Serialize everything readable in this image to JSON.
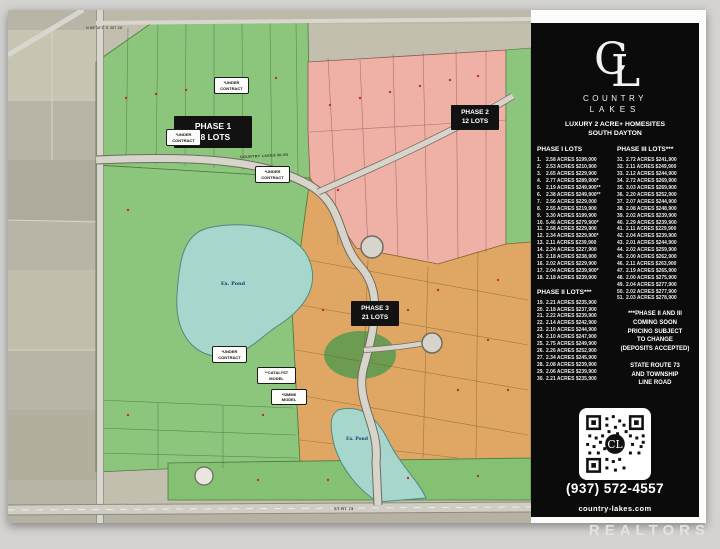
{
  "flyer": {
    "brand": {
      "monogram": "CL",
      "monogram_c": "C",
      "monogram_l": "L",
      "name_line1": "COUNTRY",
      "name_line2": "LAKES",
      "tagline_line1": "LUXURY 2 ACRE+ HOMESITES",
      "tagline_line2": "SOUTH DAYTON"
    },
    "phase1": {
      "header": "PHASE I LOTS",
      "lots": [
        {
          "n": "1.",
          "t": "2.58 ACRES $199,000"
        },
        {
          "n": "2.",
          "t": "2.53 ACRES $210,900"
        },
        {
          "n": "3.",
          "t": "2.65 ACRES $229,900"
        },
        {
          "n": "4.",
          "t": "2.77 ACRES $289,900*"
        },
        {
          "n": "5.",
          "t": "2.19 ACRES $249,900**"
        },
        {
          "n": "6.",
          "t": "2.38 ACRES $249,900**"
        },
        {
          "n": "7.",
          "t": "2.56 ACRES $229,000"
        },
        {
          "n": "8.",
          "t": "2.55 ACRES $219,900"
        },
        {
          "n": "9.",
          "t": "3.30 ACRES $199,900"
        },
        {
          "n": "10.",
          "t": "5.46 ACRES $279,900*"
        },
        {
          "n": "11.",
          "t": "2.58 ACRES $229,900"
        },
        {
          "n": "12.",
          "t": "2.34 ACRES $229,900*"
        },
        {
          "n": "13.",
          "t": "2.11 ACRES $239,900"
        },
        {
          "n": "14.",
          "t": "2.24 ACRES $227,900"
        },
        {
          "n": "15.",
          "t": "2.18 ACRES $238,900"
        },
        {
          "n": "16.",
          "t": "2.02 ACRES $229,900"
        },
        {
          "n": "17.",
          "t": "2.04 ACRES $239,900*"
        },
        {
          "n": "18.",
          "t": "2.18 ACRES $239,900"
        }
      ]
    },
    "phase2": {
      "header": "PHASE II LOTS***",
      "lots": [
        {
          "n": "19.",
          "t": "2.21 ACRES $235,900"
        },
        {
          "n": "20.",
          "t": "2.18 ACRES $237,900"
        },
        {
          "n": "21.",
          "t": "2.22 ACRES $239,900"
        },
        {
          "n": "22.",
          "t": "2.14 ACRES $242,900"
        },
        {
          "n": "23.",
          "t": "2.10 ACRES $244,900"
        },
        {
          "n": "24.",
          "t": "2.10 ACRES $247,900"
        },
        {
          "n": "25.",
          "t": "2.75 ACRES $249,900"
        },
        {
          "n": "26.",
          "t": "2.26 ACRES $252,900"
        },
        {
          "n": "27.",
          "t": "2.34 ACRES $245,900"
        },
        {
          "n": "28.",
          "t": "2.08 ACRES $239,900"
        },
        {
          "n": "29.",
          "t": "2.06 ACRES $239,900"
        },
        {
          "n": "30.",
          "t": "2.21 ACRES $235,900"
        }
      ]
    },
    "phase3": {
      "header": "PHASE III LOTS***",
      "lots": [
        {
          "n": "31.",
          "t": "2.72 ACRES $241,900"
        },
        {
          "n": "32.",
          "t": "2.11 ACRES $249,900"
        },
        {
          "n": "33.",
          "t": "2.12 ACRES $244,900"
        },
        {
          "n": "34.",
          "t": "2.72 ACRES $269,900"
        },
        {
          "n": "35.",
          "t": "3.03 ACRES $269,900"
        },
        {
          "n": "36.",
          "t": "2.20 ACRES $252,900"
        },
        {
          "n": "37.",
          "t": "2.07 ACRES $244,900"
        },
        {
          "n": "38.",
          "t": "2.08 ACRES $248,900"
        },
        {
          "n": "39.",
          "t": "2.02 ACRES $239,900"
        },
        {
          "n": "40.",
          "t": "2.29 ACRES $239,900"
        },
        {
          "n": "41.",
          "t": "2.11 ACRES $229,900"
        },
        {
          "n": "42.",
          "t": "2.04 ACRES $239,900"
        },
        {
          "n": "43.",
          "t": "2.01 ACRES $244,900"
        },
        {
          "n": "44.",
          "t": "2.02 ACRES $259,900"
        },
        {
          "n": "45.",
          "t": "2.00 ACRES $262,900"
        },
        {
          "n": "46.",
          "t": "2.11 ACRES $263,900"
        },
        {
          "n": "47.",
          "t": "2.19 ACRES $265,900"
        },
        {
          "n": "48.",
          "t": "2.00 ACRES $275,900"
        },
        {
          "n": "49.",
          "t": "2.04 ACRES $277,900"
        },
        {
          "n": "50.",
          "t": "2.02 ACRES $277,900"
        },
        {
          "n": "51.",
          "t": "2.03 ACRES $278,900"
        }
      ]
    },
    "note_lines": [
      "***PHASE II AND III",
      "COMING SOON",
      "PRICING SUBJECT",
      "TO CHANGE",
      "(DEPOSITS ACCEPTED)"
    ],
    "location_lines": [
      "STATE ROUTE 73",
      "AND TOWNSHIP",
      "LINE ROAD"
    ],
    "phone": "(937) 572-4557",
    "website": "country-lakes.com"
  },
  "map": {
    "phase1_badge": {
      "l1": "PHASE 1",
      "l2": "18 LOTS"
    },
    "phase2_badge": {
      "l1": "PHASE 2",
      "l2": "12 LOTS"
    },
    "phase3_badge": {
      "l1": "PHASE 3",
      "l2": "21 LOTS"
    },
    "under_contract": {
      "l1": "*UNDER",
      "l2": "CONTRACT"
    },
    "catalyst_model": {
      "l1": "**CATALYST",
      "l2": "MODEL"
    },
    "simms_model": {
      "l1": "*SIMMS",
      "l2": "MODEL"
    },
    "pond_label": "Ex. Pond",
    "road_label": "COUNTRY LAKES BLVD",
    "route_label": "ST RT 73",
    "survey_text": "N 89°18'3\" E  357.26'"
  },
  "watermark": {
    "text": "REALTORS"
  },
  "colors": {
    "phase1_green": "#8cc57c",
    "phase2_pink": "#efb0a6",
    "phase3_orange": "#dfa763",
    "pond_teal": "#a7d6cc",
    "panel_black": "#0b0b0b"
  }
}
